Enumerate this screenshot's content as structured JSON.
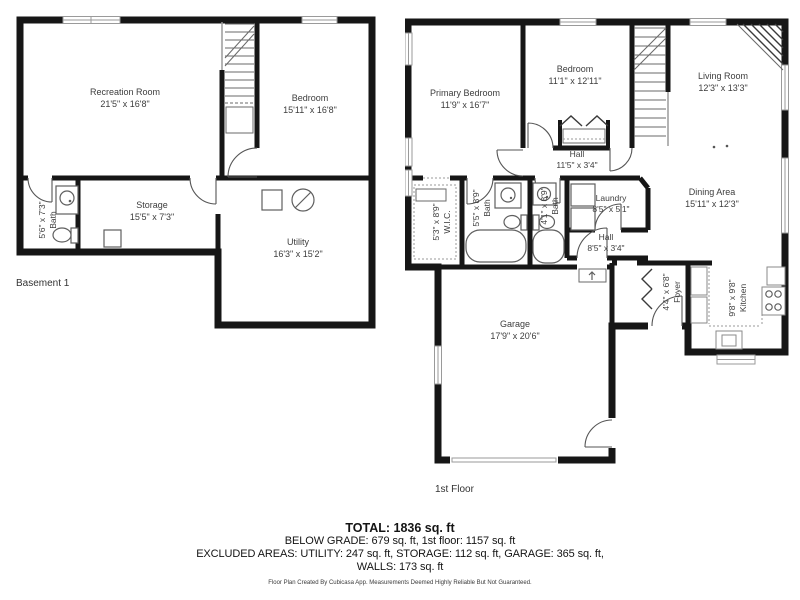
{
  "basement": {
    "floor_label": "Basement 1",
    "rooms": {
      "recreation": {
        "name": "Recreation Room",
        "dims": "21'5\" x 16'8\""
      },
      "bedroom": {
        "name": "Bedroom",
        "dims": "15'11\" x 16'8\""
      },
      "storage": {
        "name": "Storage",
        "dims": "15'5\" x 7'3\""
      },
      "utility": {
        "name": "Utility",
        "dims": "16'3\" x 15'2\""
      },
      "bath": {
        "name": "Bath",
        "dims": "5'6\" x 7'3\""
      }
    }
  },
  "first_floor": {
    "floor_label": "1st Floor",
    "rooms": {
      "primary_bedroom": {
        "name": "Primary Bedroom",
        "dims": "11'9\" x 16'7\""
      },
      "bedroom": {
        "name": "Bedroom",
        "dims": "11'1\" x 12'11\""
      },
      "living": {
        "name": "Living Room",
        "dims": "12'3\" x 13'3\""
      },
      "dining": {
        "name": "Dining Area",
        "dims": "15'11\" x 12'3\""
      },
      "kitchen": {
        "name": "Kitchen",
        "dims": "9'8\" x 9'8\""
      },
      "hall_upper": {
        "name": "Hall",
        "dims": "11'5\" x 3'4\""
      },
      "hall_lower": {
        "name": "Hall",
        "dims": "8'5\" x 3'4\""
      },
      "laundry": {
        "name": "Laundry",
        "dims": "8'5\" x 5'1\""
      },
      "wic": {
        "name": "W.I.C.",
        "dims": "5'3\" x 8'9\""
      },
      "bath1": {
        "name": "Bath",
        "dims": "5'5\" x 8'9\""
      },
      "bath2": {
        "name": "Bath",
        "dims": "4'1\" x 8'9\""
      },
      "foyer": {
        "name": "Foyer",
        "dims": "4'4\" x 6'8\""
      },
      "garage": {
        "name": "Garage",
        "dims": "17'9\" x 20'6\""
      }
    }
  },
  "footer": {
    "total": "TOTAL: 1836 sq. ft",
    "below_grade_line": "BELOW GRADE: 679 sq. ft, 1st floor: 1157 sq. ft",
    "excluded_line": "EXCLUDED AREAS: UTILITY: 247 sq. ft, STORAGE: 112 sq. ft, GARAGE: 365 sq. ft,",
    "walls_line": "WALLS: 173 sq. ft",
    "disclaimer": "Floor Plan Created By Cubicasa App. Measurements Deemed Highly Reliable But Not Guaranteed."
  },
  "colors": {
    "wall": "#161616",
    "window_frame": "#9a9a9a",
    "label_text": "#3d3d3d"
  }
}
